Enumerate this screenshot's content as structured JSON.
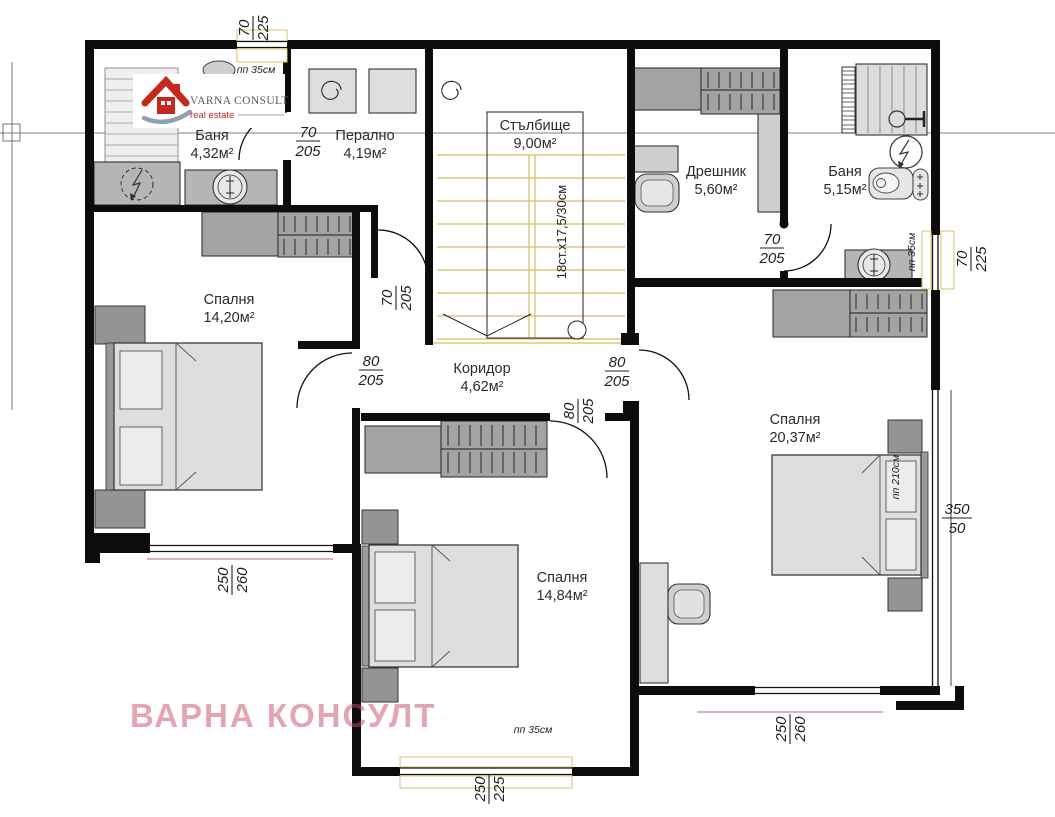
{
  "brand": {
    "name": "VARNA CONSULT",
    "tagline": "real estate"
  },
  "watermark": "ВАРНА КОНСУЛТ",
  "rooms": [
    {
      "name": "Баня",
      "area": "4,32м²"
    },
    {
      "name": "Перално",
      "area": "4,19м²"
    },
    {
      "name": "Стълбище",
      "area": "9,00м²"
    },
    {
      "name": "Дрешник",
      "area": "5,60м²"
    },
    {
      "name": "Баня",
      "area": "5,15м²"
    },
    {
      "name": "Спалня",
      "area": "14,20м²"
    },
    {
      "name": "Коридор",
      "area": "4,62м²"
    },
    {
      "name": "Спалня",
      "area": "20,37м²"
    },
    {
      "name": "Спалня",
      "area": "14,84м²"
    }
  ],
  "dimensions": [
    {
      "id": "top-window",
      "top": "70",
      "bottom": "225"
    },
    {
      "id": "bath1-door",
      "top": "70",
      "bottom": "205"
    },
    {
      "id": "stair-door",
      "top": "70",
      "bottom": "205"
    },
    {
      "id": "bedroom-left-door",
      "top": "80",
      "bottom": "205"
    },
    {
      "id": "bedroom-right-door",
      "top": "80",
      "bottom": "205"
    },
    {
      "id": "bedroom-mid-door",
      "top": "80",
      "bottom": "205"
    },
    {
      "id": "dressing-door",
      "top": "70",
      "bottom": "205"
    },
    {
      "id": "right-window",
      "top": "70",
      "bottom": "225"
    },
    {
      "id": "big-window",
      "top": "350",
      "bottom": "50"
    },
    {
      "id": "left-bottom-window",
      "top": "250",
      "bottom": "260"
    },
    {
      "id": "mid-bottom-window",
      "top": "250",
      "bottom": "225"
    },
    {
      "id": "right-bottom-window",
      "top": "250",
      "bottom": "260"
    }
  ],
  "annotations": {
    "stairs": "18ст.х17,5/30см",
    "parapet_35": "пп 35см",
    "parapet_210": "пп 210см"
  },
  "colors": {
    "wall": "#0c0c0c",
    "stair_yellow": "#d4bd62",
    "window_red": "#c06868",
    "watermark_pink": "#c94f63",
    "logo_red": "#c4281e"
  }
}
